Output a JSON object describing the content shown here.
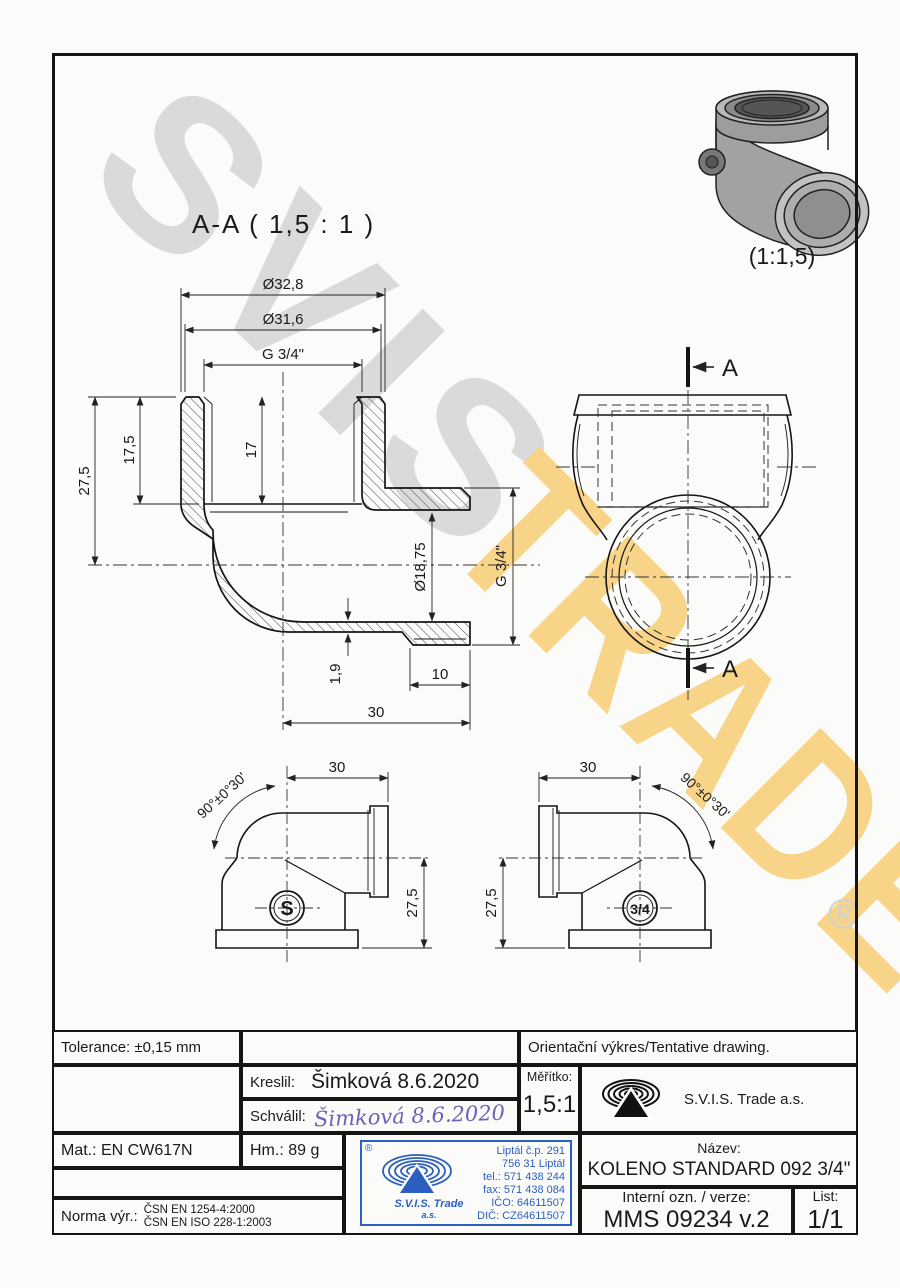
{
  "watermark": {
    "svis": "SVIS",
    "trade": "TRADE",
    "registered": "®",
    "gray": "#dadada",
    "yellow": "#f7d488"
  },
  "header": {
    "section_title": "A-A ( 1,5 : 1 )",
    "photo_scale": "(1:1,5)"
  },
  "section": {
    "dia_outer": "Ø32,8",
    "dia_mid": "Ø31,6",
    "thread_top": "G 3/4\"",
    "h_total": "27,5",
    "h_socket": "17,5",
    "h_thread": "17",
    "dia_bore": "Ø18,75",
    "thread_right": "G 3/4\"",
    "wall": "1,9",
    "len_thread": "10",
    "len_branch": "30"
  },
  "topview": {
    "cut_top": "A",
    "cut_bottom": "A"
  },
  "side_left": {
    "len": "30",
    "angle": "90°±0°30'",
    "height": "27,5",
    "mark": "S"
  },
  "side_right": {
    "len": "30",
    "angle": "90°±0°30'",
    "height": "27,5",
    "mark": "3/4"
  },
  "titleblock": {
    "tolerance": "Tolerance: ±0,15 mm",
    "orient": "Orientační výkres/Tentative drawing.",
    "kreslil_label": "Kreslil:",
    "kreslil_value": "Šimková 8.6.2020",
    "schvalil_label": "Schválil:",
    "schvalil_sig": "Šimková 8.6.2020",
    "meritko_label": "Měřítko:",
    "meritko_value": "1,5:1",
    "company": "S.V.I.S. Trade a.s.",
    "mat": "Mat.: EN CW617N",
    "hm": "Hm.: 89 g",
    "norma_label": "Norma výr.:",
    "norma1": "ČSN EN 1254-4:2000",
    "norma2": "ČSN EN ISO 228-1:2003",
    "nazev_label": "Název:",
    "nazev_value": "KOLENO STANDARD 092 3/4\"",
    "interni_label": "Interní ozn. / verze:",
    "interni_value": "MMS 09234 v.2",
    "list_label": "List:",
    "list_value": "1/1",
    "stamp": {
      "reg": "®",
      "lines": [
        "Liptál č.p. 291",
        "756 31 Liptál",
        "tel.: 571 438 244",
        "fax: 571 438 084",
        "IČO: 64611507",
        "DIČ: CZ64611507"
      ],
      "company": "S.V.I.S. Trade",
      "suffix": "a.s."
    }
  }
}
